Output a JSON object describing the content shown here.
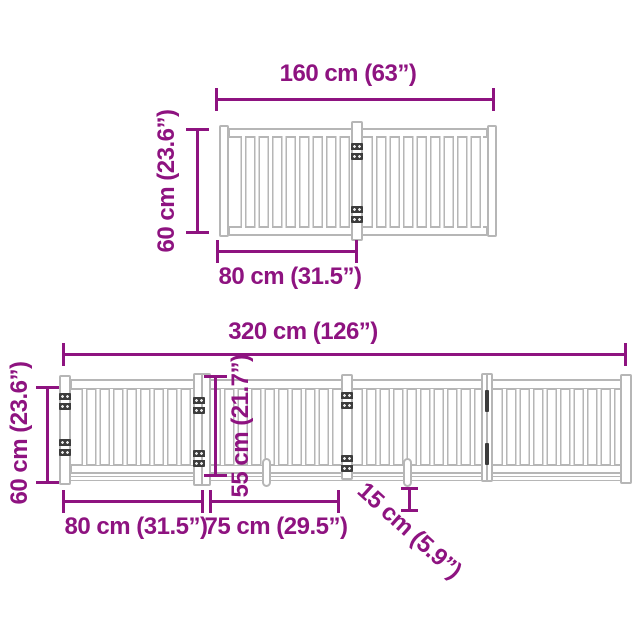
{
  "colors": {
    "accent": "#8E1380",
    "gate_outline": "#b6b6b6",
    "hinge": "#3c3c3c",
    "background": "#ffffff"
  },
  "top_diagram": {
    "width_label": "160 cm (63”)",
    "height_label": "60 cm (23.6”)",
    "panel_width_label": "80 cm (31.5”)"
  },
  "bottom_diagram": {
    "total_width_label": "320 cm (126”)",
    "height_label": "60 cm (23.6”)",
    "door_height_label": "55 cm (21.7”)",
    "first_panel_label": "80 cm (31.5”)",
    "second_panel_label": "75 cm (29.5”)",
    "foot_label": "15 cm (5.9”)"
  }
}
